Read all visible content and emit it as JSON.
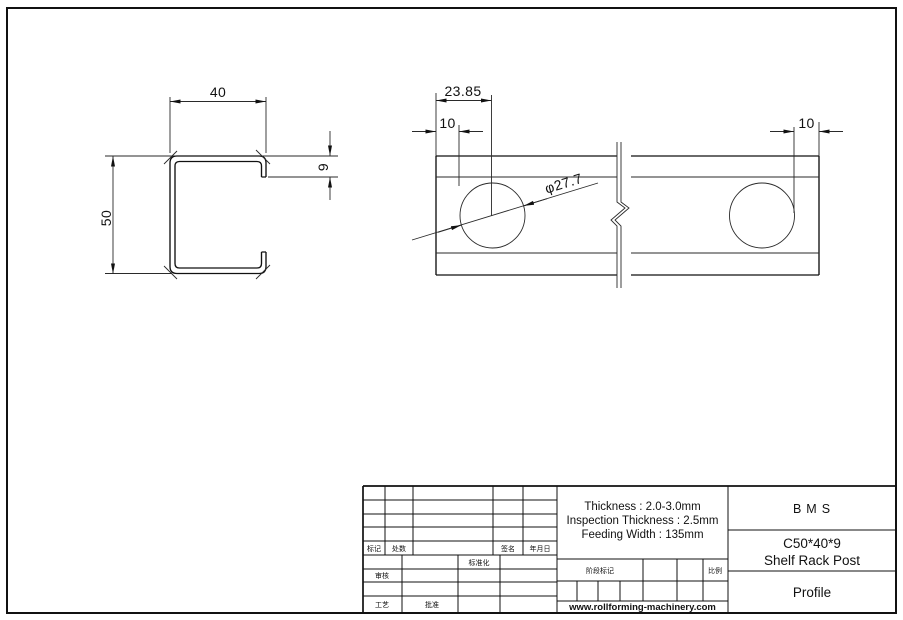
{
  "colors": {
    "ink": "#111111",
    "background": "#ffffff"
  },
  "views": {
    "c_section": {
      "dim_width": "40",
      "dim_height": "50",
      "dim_lip": "9"
    },
    "strip": {
      "dim_hole_offset": "23.85",
      "dim_left_margin": "10",
      "dim_hole_dia": "φ27.7",
      "dim_right_margin": "10"
    }
  },
  "title_block": {
    "revision_labels": {
      "mark": "标记",
      "count": "处数",
      "signature": "签名",
      "date": "年月日"
    },
    "approval_labels": {
      "standardization": "标准化",
      "check": "审核",
      "process": "工艺",
      "approve": "批准",
      "stage": "阶段标记",
      "scale": "比例"
    },
    "specs": {
      "line1": "Thickness : 2.0-3.0mm",
      "line2": "Inspection Thickness : 2.5mm",
      "line3": "Feeding Width : 135mm"
    },
    "company": "BMS",
    "model": "C50*40*9",
    "product": "Shelf Rack Post",
    "doc_type": "Profile",
    "website": "www.rollforming-machinery.com"
  }
}
